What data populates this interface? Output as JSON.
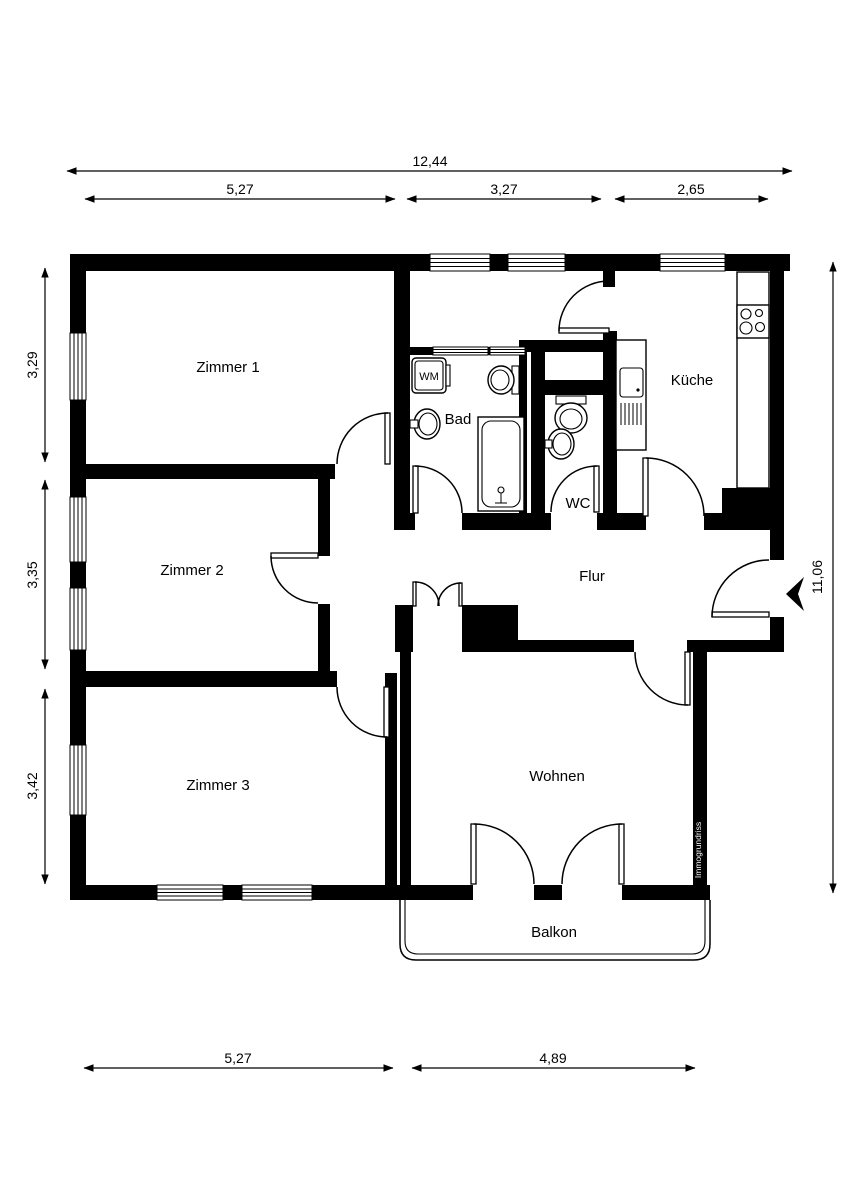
{
  "plan_title": "Wohnungsgrundriss",
  "rooms": {
    "zimmer1": "Zimmer 1",
    "zimmer2": "Zimmer 2",
    "zimmer3": "Zimmer 3",
    "bad": "Bad",
    "wc": "WC",
    "kueche": "Küche",
    "flur": "Flur",
    "wohnen": "Wohnen",
    "balkon": "Balkon"
  },
  "fixtures": {
    "washing_machine": "WM"
  },
  "watermark": "Immogrundriss",
  "dimensions": {
    "top_total": "12,44",
    "top": [
      "5,27",
      "3,27",
      "2,65"
    ],
    "left": [
      "3,29",
      "3,35",
      "3,42"
    ],
    "right": "11,06",
    "bottom": [
      "5,27",
      "4,89"
    ]
  },
  "colors": {
    "wall": "#000000",
    "background": "#ffffff",
    "watermark_text": "#ffffff"
  }
}
